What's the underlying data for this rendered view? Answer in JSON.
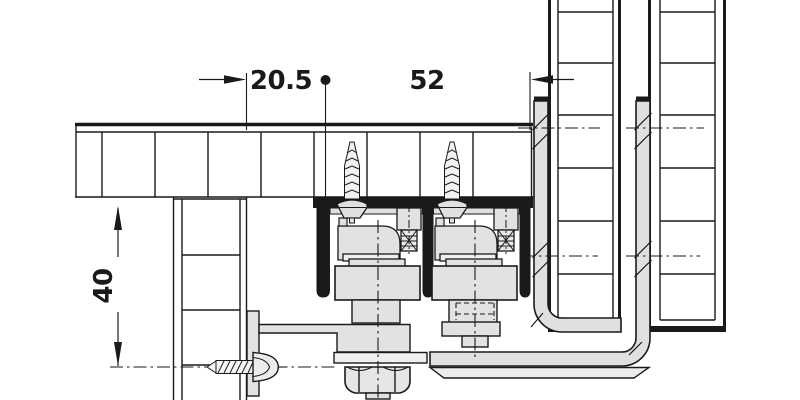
{
  "diagram": {
    "type": "technical cross-section of sliding-door top-track fitting",
    "dimensions": {
      "offset": {
        "label": "20.5"
      },
      "spacing": {
        "label": "52"
      },
      "height": {
        "label": "40"
      }
    },
    "colors": {
      "line": "#1a1a1a",
      "metal_light": "#e2e2e2",
      "metal_lighter": "#efefef",
      "background": "#ffffff"
    }
  }
}
